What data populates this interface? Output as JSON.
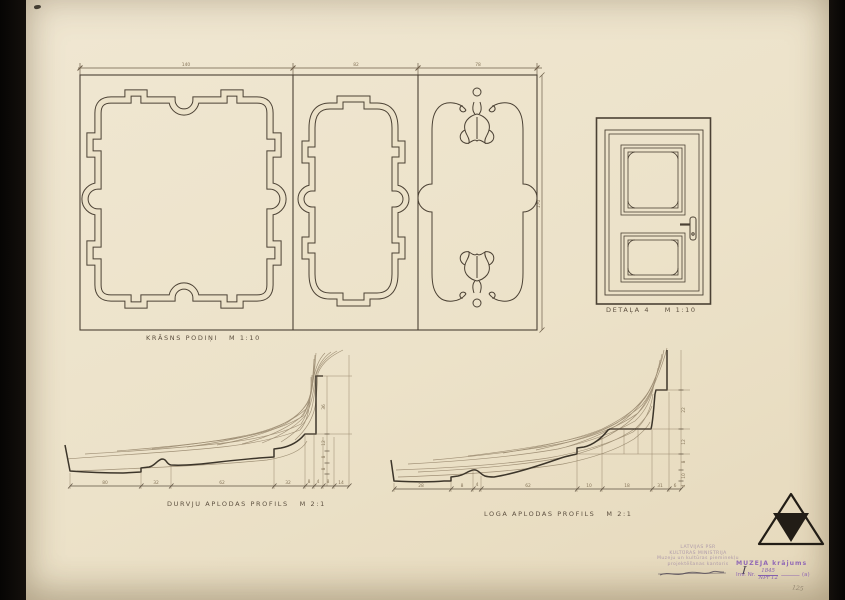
{
  "labels": {
    "panels": "KRĀSNS PODIŅI   M 1:10",
    "door": "DETAĻA 4    M 1:10",
    "profile_left": "DURVJU APLODAS PROFILS   M 2:1",
    "profile_right": "LOGA APLODAS PROFILS   M 2:1"
  },
  "dimensions": {
    "panels_top": [
      "140",
      "82",
      "78"
    ],
    "panels_right": "170",
    "profile_left_chain": [
      "80",
      "32",
      "62",
      "32",
      "8",
      "4",
      "8",
      "14"
    ],
    "profile_left_vertical": [
      "36",
      "12",
      "8",
      "8"
    ],
    "profile_right_chain": [
      "28",
      "8",
      "4",
      "62",
      "10",
      "18",
      "31",
      "6"
    ],
    "profile_right_vertical": [
      "22",
      "12",
      "8",
      "10",
      "4"
    ]
  },
  "stamps": {
    "institution_faint": {
      "lines": [
        "LATVIJAS PSR",
        "KULTŪRAS MINISTRIJA",
        "Muzeju un kultūras pieminekļu",
        "projektēšanas kantoris"
      ],
      "handwritten": "I"
    },
    "museum": {
      "title": "MUZEJA krājums",
      "inv_label": "Inv. Nr.",
      "inv_number_top": "1845",
      "inv_number_bottom": "NPr 12",
      "suffix": "(a)",
      "pencil_note": "125"
    }
  },
  "colors": {
    "paper": "#ece2c9",
    "ink": "#4b4134",
    "stamp_purple": "#8a5fb5",
    "logo_black": "#221d16"
  }
}
